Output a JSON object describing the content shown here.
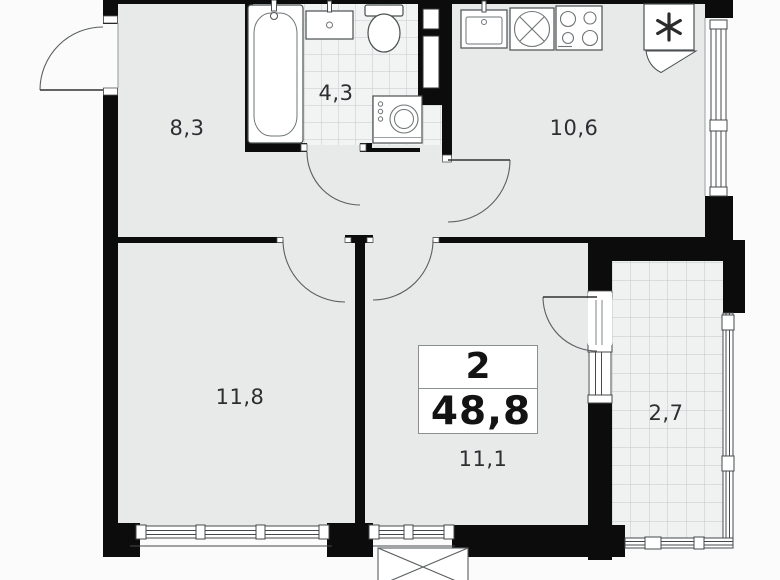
{
  "plan": {
    "type": "apartment-floor-plan",
    "summary": {
      "room_count": "2",
      "total_area": "48,8"
    },
    "rooms": [
      {
        "name": "entry-hall-room",
        "area_label": "8,3"
      },
      {
        "name": "bathroom",
        "area_label": "4,3"
      },
      {
        "name": "kitchen",
        "area_label": "10,6"
      },
      {
        "name": "room-left",
        "area_label": "11,8"
      },
      {
        "name": "room-right",
        "area_label": "11,1"
      },
      {
        "name": "balcony",
        "area_label": "2,7"
      }
    ],
    "fixtures": [
      "bathtub",
      "bathroom-sink",
      "toilet",
      "washing-machine",
      "vent-shaft",
      "kitchen-sink",
      "hob",
      "stove",
      "fridge",
      "ac-unit"
    ],
    "colors": {
      "wall": "#0c0c0c",
      "floor": "#e8eaea",
      "tile_floor": "#f2f4f4",
      "tile_line": "#c3c9c9",
      "outline": "#4a4f51",
      "background": "#fbfbfb",
      "text": "#2c2f31"
    }
  }
}
